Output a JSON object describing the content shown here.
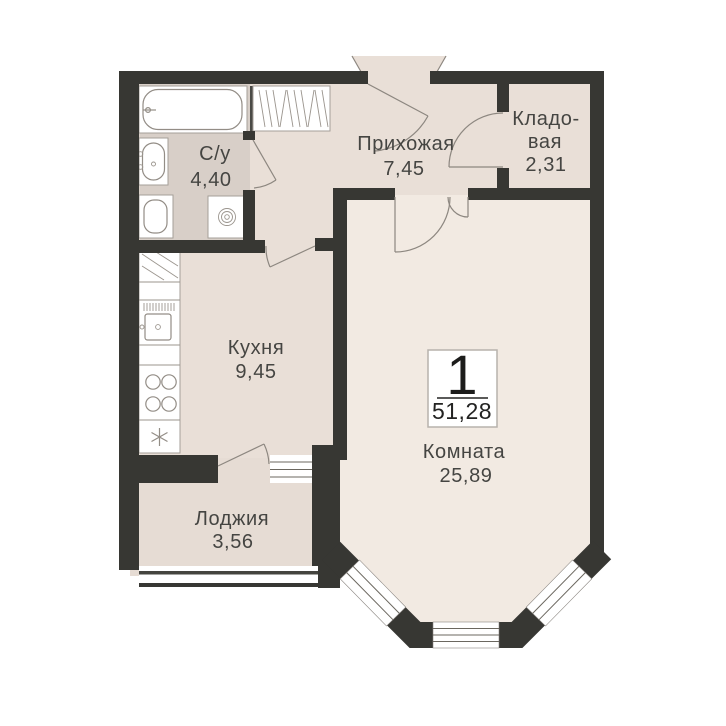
{
  "plan": {
    "type": "apartment-floor-plan",
    "badge": {
      "rooms_count": "1",
      "total_area": "51,28"
    },
    "rooms": {
      "bathroom": {
        "label": "С/у",
        "area": "4,40"
      },
      "hallway": {
        "label": "Прихожая",
        "area": "7,45"
      },
      "storage": {
        "label_line1": "Кладо-",
        "label_line2": "вая",
        "area": "2,31"
      },
      "kitchen": {
        "label": "Кухня",
        "area": "9,45"
      },
      "room": {
        "label": "Комната",
        "area": "25,89"
      },
      "loggia": {
        "label": "Лоджия",
        "area": "3,56"
      }
    },
    "colors": {
      "wall": "#373733",
      "floor_hallway_kitchen": "#e9dfd7",
      "floor_bathroom": "#d8cfc8",
      "floor_room": "#f2eae2",
      "floor_loggia": "#e6dcd4",
      "fixture_outline": "#938d86",
      "label_text": "#454542",
      "background": "#ffffff"
    },
    "icons": {
      "bathtub-icon": "rounded tub outline with faucet dot",
      "sink-icon": "oval basin with taps",
      "toilet-icon": "rounded bowl outline",
      "washing-machine-icon": "square with concentric drum circles",
      "wardrobe-icon": "hatched closet box",
      "kitchen-counter-icon": "counter strip: cabinet, sink, 4-burner stove, snowflake unit",
      "window-icon": "white band with parallel glazing lines",
      "door-swing-icon": "leaf line with quarter arc"
    }
  }
}
